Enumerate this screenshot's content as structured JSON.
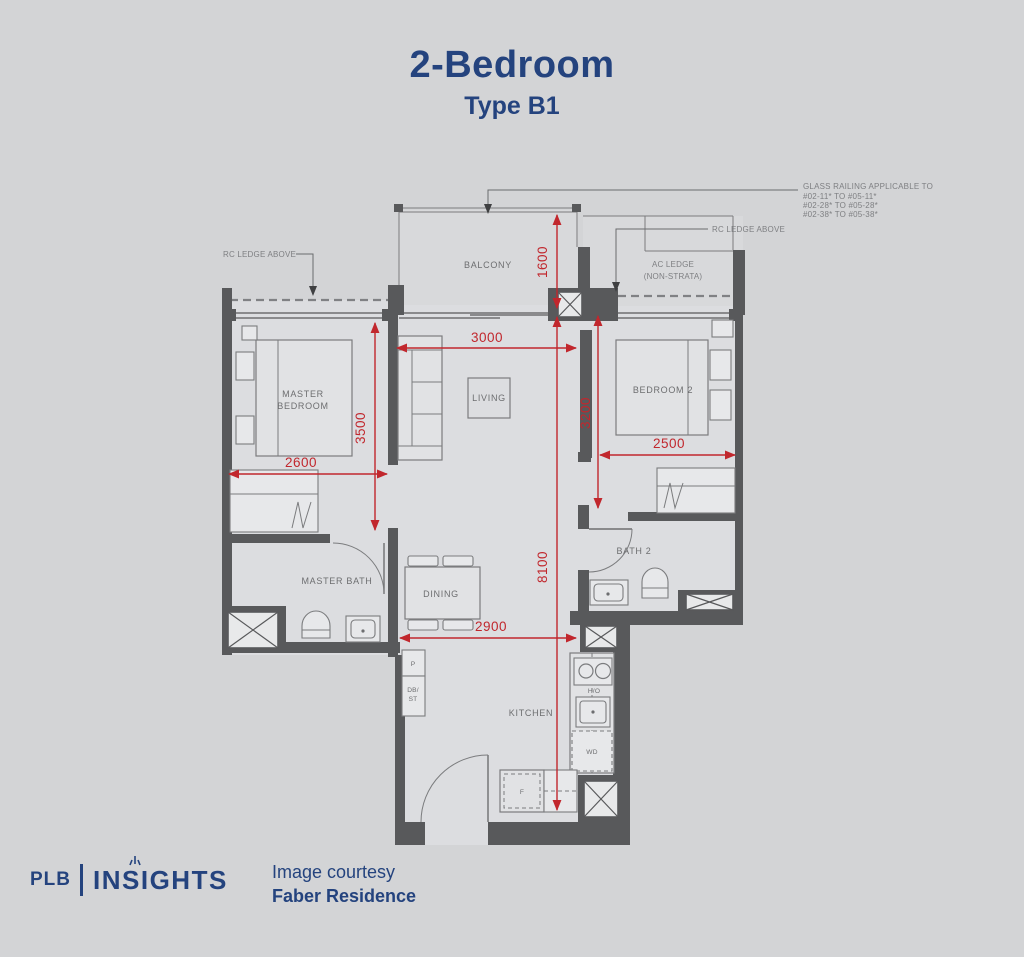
{
  "title": {
    "heading": "2-Bedroom",
    "subheading": "Type B1"
  },
  "floorplan": {
    "rooms": {
      "balcony": "BALCONY",
      "living": "LIVING",
      "master_bedroom": [
        "MASTER",
        "BEDROOM"
      ],
      "bedroom2": "BEDROOM 2",
      "master_bath": "MASTER BATH",
      "bath2": "BATH 2",
      "dining": "DINING",
      "kitchen": "KITCHEN"
    },
    "fixtures": {
      "pantry": "P",
      "db_store": [
        "DB/",
        "ST"
      ],
      "hob": "H/O",
      "washer_dryer": "WD",
      "fridge": "F"
    },
    "annotations": {
      "glass_railing": [
        "GLASS RAILING APPLICABLE TO",
        "#02-11* TO #05-11*",
        "#02-28* TO #05-28*",
        "#02-38* TO #05-38*"
      ],
      "rc_ledge_left": "RC LEDGE ABOVE",
      "rc_ledge_right": "RC LEDGE ABOVE",
      "ac_ledge": [
        "AC LEDGE",
        "(NON-STRATA)"
      ]
    },
    "dimensions": {
      "balcony_depth": "1600",
      "living_width": "3000",
      "master_bedroom_depth": "3500",
      "master_bedroom_width": "2600",
      "bedroom2_depth": "3200",
      "bedroom2_width": "2500",
      "overall_depth": "8100",
      "dining_kitchen_width": "2900"
    }
  },
  "footer": {
    "brand_prefix": "PLB",
    "brand_name": "INSIGHTS",
    "courtesy": [
      "Image courtesy",
      "Faber Residence"
    ]
  },
  "colors": {
    "navy": "#24437e",
    "dimension_red": "#c1272d",
    "wall_gray": "#58595b",
    "background": "#d3d4d6"
  }
}
